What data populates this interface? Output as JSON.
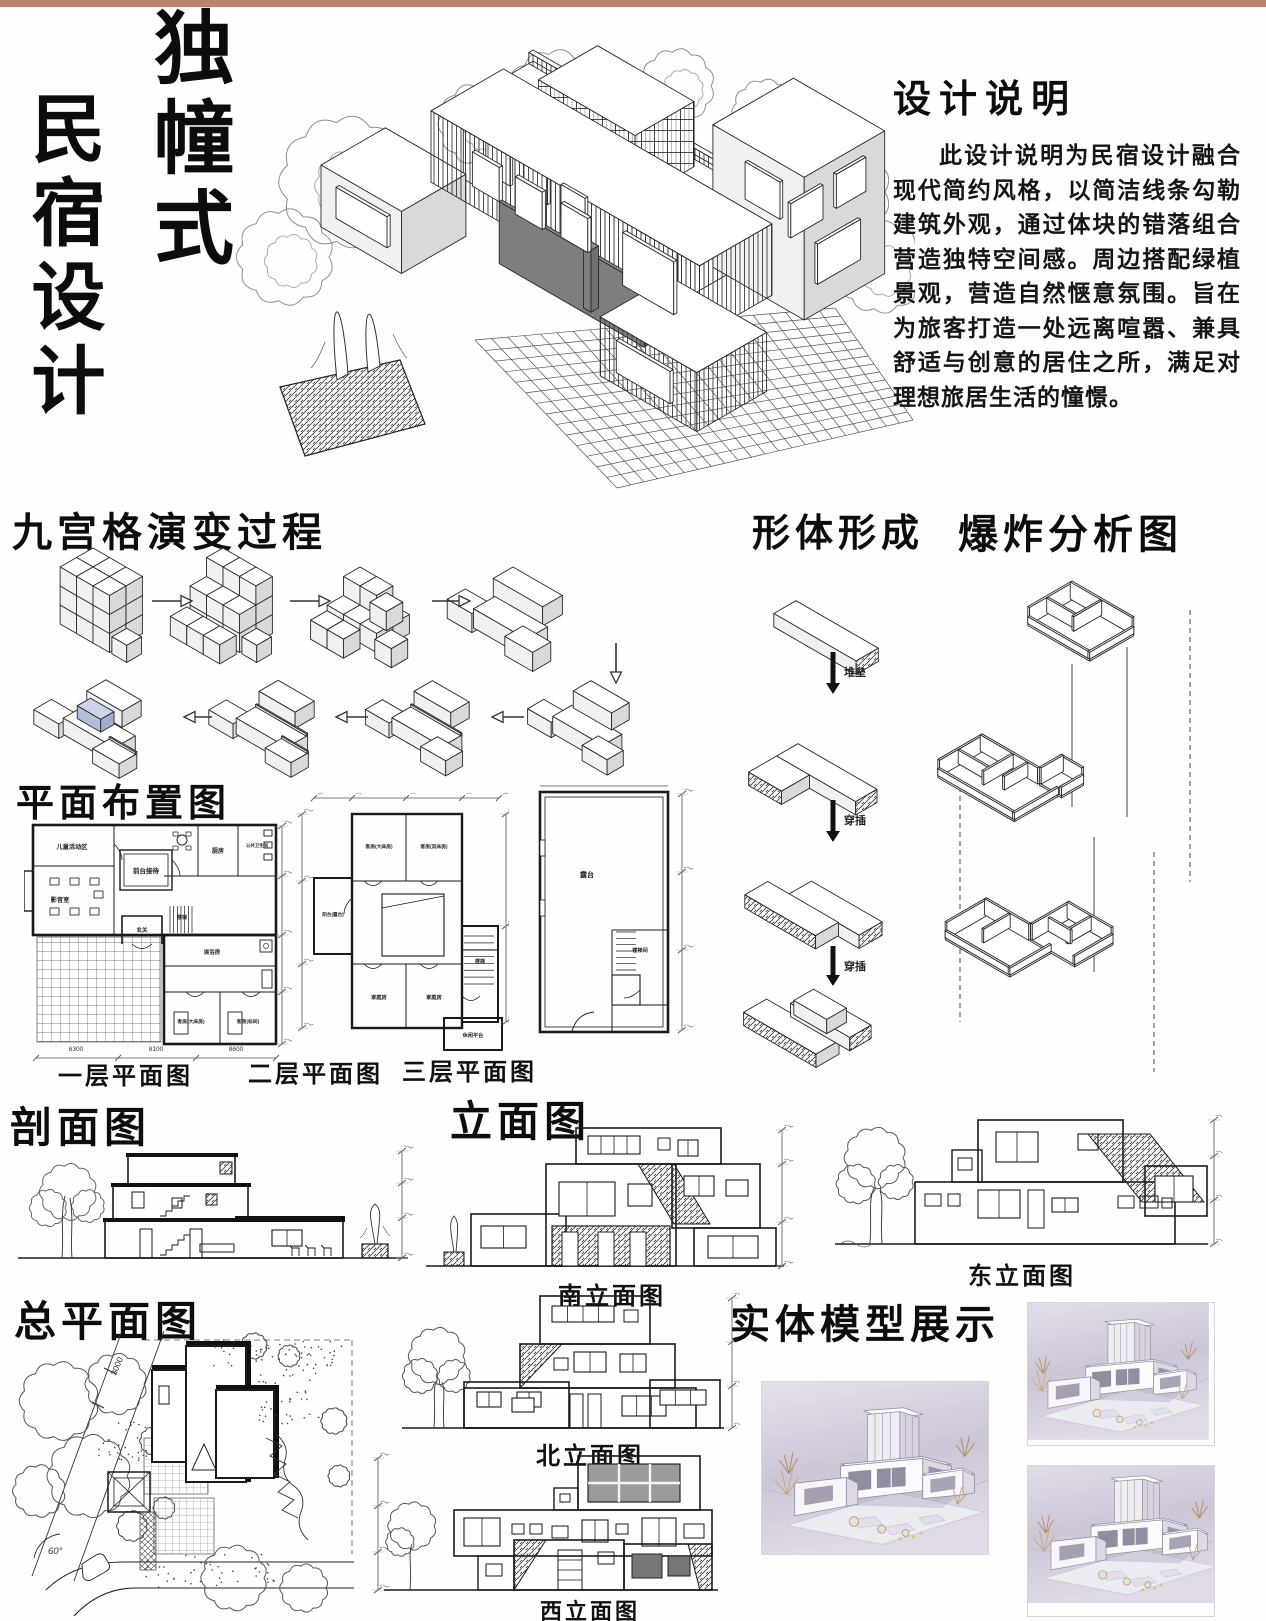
{
  "page": {
    "top_bar_color": "#b9836f",
    "background": "#fefefe"
  },
  "title": {
    "line1": "独幢式",
    "line2": "民宿设计"
  },
  "design_notes": {
    "heading": "设计说明",
    "body": "此设计说明为民宿设计融合现代简约风格，以简洁线条勾勒建筑外观，通过体块的错落组合营造独特空间感。周边搭配绿植景观，营造自然惬意氛围。旨在为旅客打造一处远离喧嚣、兼具舒适与创意的居住之所，满足对理想旅居生活的憧憬。"
  },
  "sections": {
    "nine_grid": {
      "heading": "九宫格演变过程"
    },
    "form": {
      "heading": "形体形成",
      "step_labels": [
        "堆垒",
        "穿插",
        "穿插"
      ]
    },
    "exploded": {
      "heading": "爆炸分析图"
    },
    "plans": {
      "heading": "平面布置图",
      "captions": [
        "一层平面图",
        "二层平面图",
        "三层平面图"
      ],
      "plan1_rooms": [
        "儿童活动区",
        "影音室",
        "前台接待",
        "厨房",
        "公共卫生间",
        "玄关",
        "楼梯",
        "淋浴房",
        "客房(大床房)",
        "客房(标间)"
      ],
      "plan1_dims": [
        "6300",
        "8100",
        "8600"
      ],
      "plan2_rooms": [
        "客房(大床房)",
        "客房(双床房)",
        "阳台(露台)",
        "楼梯",
        "家庭房",
        "家庭房",
        "休闲平台"
      ],
      "plan3_rooms": [
        "露台",
        "楼梯间"
      ]
    },
    "section_view": {
      "heading": "剖面图"
    },
    "elevations": {
      "heading": "立面图",
      "captions": [
        "南立面图",
        "东立面图",
        "北立面图",
        "西立面图"
      ]
    },
    "site": {
      "heading": "总平面图",
      "labels": {
        "dim": "3000",
        "angle": "60°"
      }
    },
    "model": {
      "heading": "实体模型展示"
    }
  }
}
